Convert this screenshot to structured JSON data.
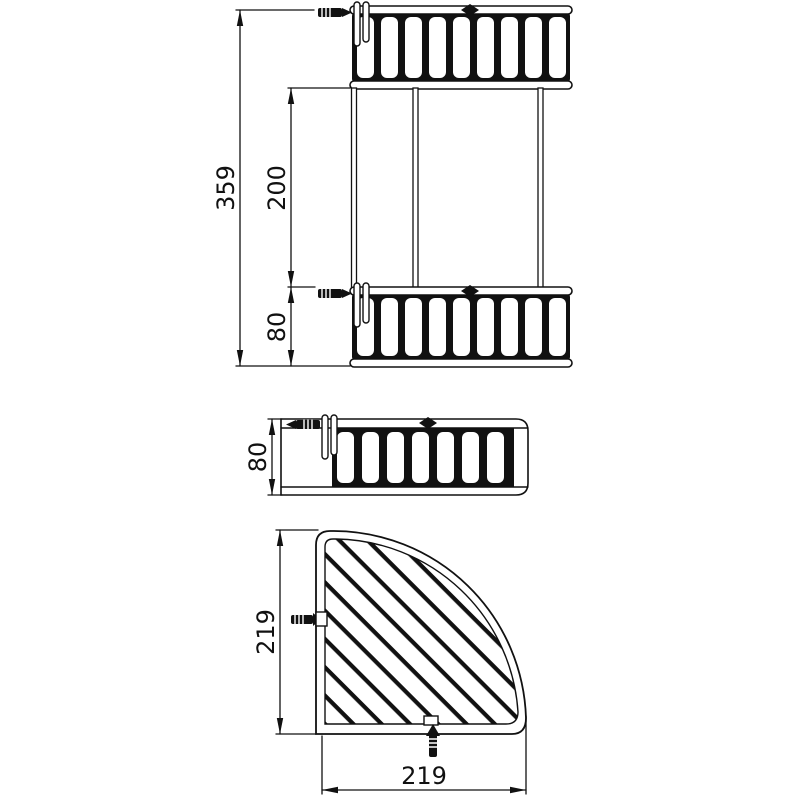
{
  "page": {
    "background": "#ffffff",
    "line_color": "#111111"
  },
  "views": {
    "front": {
      "dims": {
        "total_height": "359",
        "post_height": "200",
        "basket_height": "80"
      }
    },
    "side": {
      "dims": {
        "basket_height": "80"
      }
    },
    "plan": {
      "dims": {
        "depth": "219",
        "width": "219"
      }
    }
  }
}
